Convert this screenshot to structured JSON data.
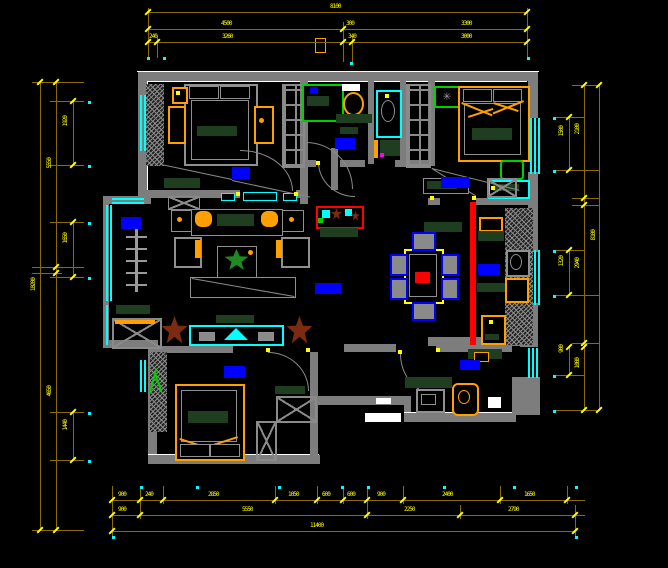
{
  "app": {
    "name": "cad-floor-plan-view",
    "drawing_type": "apartment furniture layout plan"
  },
  "colors": {
    "background": "#000000",
    "walls": "#7d7d7d",
    "dimension_line": "#8a6d00",
    "dimension_text": "#ffff00",
    "window": "#00ffff",
    "room_label_block": "#0000ff",
    "furniture_accent": "#ffa000",
    "highlight_wall": "#ff0000",
    "counter": "#1f3d1f",
    "fixture_green": "#00d000",
    "plant_brown": "#7b2b10"
  },
  "dim_labels": [
    {
      "t": "8100",
      "x": 330,
      "y": 4,
      "v": 0
    },
    {
      "t": "4500",
      "x": 221,
      "y": 21,
      "v": 0
    },
    {
      "t": "300",
      "x": 346,
      "y": 21,
      "v": 0
    },
    {
      "t": "3300",
      "x": 461,
      "y": 21,
      "v": 0
    },
    {
      "t": "240",
      "x": 149,
      "y": 34,
      "v": 0
    },
    {
      "t": "3260",
      "x": 222,
      "y": 34,
      "v": 0
    },
    {
      "t": "340",
      "x": 348,
      "y": 34,
      "v": 0
    },
    {
      "t": "3000",
      "x": 461,
      "y": 34,
      "v": 0
    },
    {
      "t": "10200",
      "x": 31,
      "y": 278,
      "v": 1
    },
    {
      "t": "5550",
      "x": 47,
      "y": 158,
      "v": 1
    },
    {
      "t": "4650",
      "x": 47,
      "y": 386,
      "v": 1
    },
    {
      "t": "1920",
      "x": 63,
      "y": 116,
      "v": 1
    },
    {
      "t": "1650",
      "x": 63,
      "y": 233,
      "v": 1
    },
    {
      "t": "1440",
      "x": 63,
      "y": 420,
      "v": 1
    },
    {
      "t": "8100",
      "x": 591,
      "y": 230,
      "v": 1
    },
    {
      "t": "2100",
      "x": 575,
      "y": 124,
      "v": 1
    },
    {
      "t": "2940",
      "x": 575,
      "y": 258,
      "v": 1
    },
    {
      "t": "1080",
      "x": 575,
      "y": 358,
      "v": 1
    },
    {
      "t": "1500",
      "x": 559,
      "y": 126,
      "v": 1
    },
    {
      "t": "1320",
      "x": 559,
      "y": 256,
      "v": 1
    },
    {
      "t": "900",
      "x": 559,
      "y": 345,
      "v": 1
    },
    {
      "t": "900",
      "x": 118,
      "y": 492,
      "v": 0
    },
    {
      "t": "240",
      "x": 145,
      "y": 492,
      "v": 0
    },
    {
      "t": "2850",
      "x": 208,
      "y": 492,
      "v": 0
    },
    {
      "t": "1050",
      "x": 288,
      "y": 492,
      "v": 0
    },
    {
      "t": "600",
      "x": 322,
      "y": 492,
      "v": 0
    },
    {
      "t": "600",
      "x": 347,
      "y": 492,
      "v": 0
    },
    {
      "t": "900",
      "x": 377,
      "y": 492,
      "v": 0
    },
    {
      "t": "2400",
      "x": 442,
      "y": 492,
      "v": 0
    },
    {
      "t": "1650",
      "x": 524,
      "y": 492,
      "v": 0
    },
    {
      "t": "900",
      "x": 118,
      "y": 507,
      "v": 0
    },
    {
      "t": "5550",
      "x": 242,
      "y": 507,
      "v": 0
    },
    {
      "t": "2250",
      "x": 404,
      "y": 507,
      "v": 0
    },
    {
      "t": "2790",
      "x": 508,
      "y": 507,
      "v": 0
    },
    {
      "t": "11400",
      "x": 310,
      "y": 523,
      "v": 0
    }
  ],
  "dim_lines": [
    [
      148,
      12,
      380,
      1
    ],
    [
      148,
      29,
      380,
      1
    ],
    [
      148,
      42,
      380,
      1
    ],
    [
      148,
      8,
      1,
      50
    ],
    [
      157,
      36,
      1,
      22
    ],
    [
      343,
      22,
      1,
      40
    ],
    [
      352,
      36,
      1,
      26
    ],
    [
      527,
      8,
      1,
      50
    ],
    [
      40,
      82,
      1,
      448
    ],
    [
      56,
      82,
      1,
      448
    ],
    [
      73,
      101,
      1,
      64
    ],
    [
      73,
      222,
      1,
      55
    ],
    [
      73,
      412,
      1,
      48
    ],
    [
      32,
      82,
      52,
      1
    ],
    [
      50,
      101,
      34,
      1
    ],
    [
      50,
      165,
      34,
      1
    ],
    [
      32,
      267,
      52,
      1
    ],
    [
      32,
      273,
      30,
      1
    ],
    [
      50,
      222,
      34,
      1
    ],
    [
      50,
      277,
      34,
      1
    ],
    [
      50,
      412,
      34,
      1
    ],
    [
      50,
      460,
      34,
      1
    ],
    [
      32,
      530,
      52,
      1
    ],
    [
      569,
      117,
      1,
      53
    ],
    [
      569,
      250,
      1,
      45
    ],
    [
      569,
      347,
      1,
      28
    ],
    [
      584,
      85,
      1,
      325
    ],
    [
      599,
      85,
      1,
      325
    ],
    [
      572,
      85,
      28,
      1
    ],
    [
      556,
      117,
      28,
      1
    ],
    [
      556,
      170,
      44,
      1
    ],
    [
      572,
      198,
      28,
      1
    ],
    [
      572,
      205,
      28,
      1
    ],
    [
      556,
      250,
      28,
      1
    ],
    [
      556,
      295,
      44,
      1
    ],
    [
      572,
      343,
      28,
      1
    ],
    [
      556,
      375,
      28,
      1
    ],
    [
      556,
      410,
      44,
      1
    ],
    [
      112,
      500,
      473,
      1
    ],
    [
      112,
      515,
      473,
      1
    ],
    [
      112,
      531,
      463,
      1
    ],
    [
      112,
      486,
      1,
      50
    ],
    [
      140,
      486,
      1,
      33
    ],
    [
      163,
      486,
      1,
      18
    ],
    [
      275,
      486,
      1,
      18
    ],
    [
      317,
      486,
      1,
      18
    ],
    [
      343,
      486,
      1,
      18
    ],
    [
      367,
      486,
      1,
      33
    ],
    [
      403,
      486,
      1,
      18
    ],
    [
      500,
      486,
      1,
      18
    ],
    [
      567,
      486,
      1,
      18
    ],
    [
      575,
      505,
      1,
      31
    ],
    [
      460,
      505,
      1,
      14
    ]
  ],
  "ticks": [
    [
      148,
      12
    ],
    [
      527,
      12
    ],
    [
      148,
      29
    ],
    [
      343,
      29
    ],
    [
      527,
      29
    ],
    [
      148,
      42
    ],
    [
      157,
      42
    ],
    [
      343,
      42
    ],
    [
      352,
      42
    ],
    [
      527,
      42
    ],
    [
      40,
      82
    ],
    [
      40,
      530
    ],
    [
      56,
      82
    ],
    [
      56,
      267
    ],
    [
      56,
      273
    ],
    [
      56,
      530
    ],
    [
      73,
      101
    ],
    [
      73,
      165
    ],
    [
      73,
      222
    ],
    [
      73,
      277
    ],
    [
      73,
      412
    ],
    [
      73,
      460
    ],
    [
      584,
      85
    ],
    [
      584,
      198
    ],
    [
      584,
      205
    ],
    [
      584,
      343
    ],
    [
      584,
      347
    ],
    [
      584,
      410
    ],
    [
      599,
      85
    ],
    [
      599,
      410
    ],
    [
      569,
      117
    ],
    [
      569,
      170
    ],
    [
      569,
      250
    ],
    [
      569,
      295
    ],
    [
      569,
      347
    ],
    [
      569,
      375
    ],
    [
      112,
      500
    ],
    [
      140,
      500
    ],
    [
      163,
      500
    ],
    [
      275,
      500
    ],
    [
      317,
      500
    ],
    [
      343,
      500
    ],
    [
      367,
      500
    ],
    [
      403,
      500
    ],
    [
      500,
      500
    ],
    [
      567,
      500
    ],
    [
      112,
      515
    ],
    [
      140,
      515
    ],
    [
      367,
      515
    ],
    [
      460,
      515
    ],
    [
      575,
      515
    ],
    [
      112,
      531
    ],
    [
      575,
      531
    ]
  ],
  "cyan_dots": [
    [
      147,
      57
    ],
    [
      163,
      57
    ],
    [
      350,
      62
    ],
    [
      527,
      57
    ],
    [
      88,
      101
    ],
    [
      88,
      165
    ],
    [
      88,
      222
    ],
    [
      88,
      277
    ],
    [
      88,
      412
    ],
    [
      88,
      460
    ],
    [
      553,
      117
    ],
    [
      553,
      170
    ],
    [
      553,
      250
    ],
    [
      553,
      295
    ],
    [
      553,
      375
    ],
    [
      553,
      410
    ],
    [
      140,
      486
    ],
    [
      196,
      486
    ],
    [
      278,
      486
    ],
    [
      341,
      486
    ],
    [
      367,
      486
    ],
    [
      443,
      486
    ],
    [
      513,
      486
    ],
    [
      575,
      486
    ],
    [
      112,
      536
    ],
    [
      575,
      536
    ]
  ],
  "room_label_blocks": [
    {
      "room": "bedroom-top-left",
      "x": 232,
      "y": 167,
      "w": 18,
      "h": 12
    },
    {
      "room": "bathroom",
      "x": 335,
      "y": 138,
      "w": 20,
      "h": 11
    },
    {
      "room": "bedroom-top-right",
      "x": 441,
      "y": 177,
      "w": 28,
      "h": 11
    },
    {
      "room": "balcony",
      "x": 121,
      "y": 217,
      "w": 20,
      "h": 12
    },
    {
      "room": "living-room",
      "x": 315,
      "y": 283,
      "w": 26,
      "h": 11
    },
    {
      "room": "kitchen-cabinets",
      "x": 478,
      "y": 264,
      "w": 22,
      "h": 11
    },
    {
      "room": "bedroom-bottom-left",
      "x": 224,
      "y": 366,
      "w": 21,
      "h": 12
    },
    {
      "room": "kitchen-room",
      "x": 460,
      "y": 360,
      "w": 20,
      "h": 10
    }
  ]
}
